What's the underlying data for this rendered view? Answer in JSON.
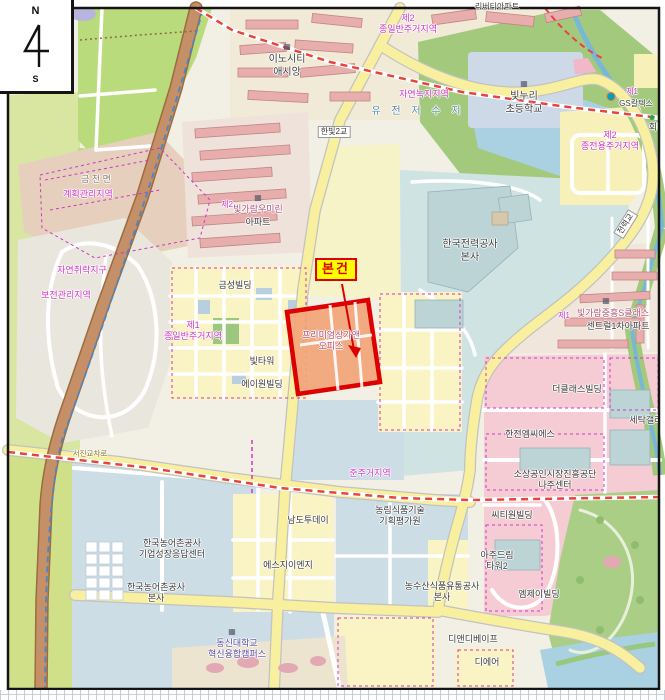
{
  "compass": {
    "north": "N",
    "south": "S"
  },
  "palette": {
    "zone-magenta": "#cf36c4",
    "subject-red": "#dd0000",
    "subject-bg": "#ffff00",
    "poi-dark": "#3c3c3c",
    "water-blue": "#5a84a0",
    "apt-rose": "#b0567c",
    "univ-purple": "#5a4a9e",
    "road-olive": "#8a7a28",
    "gray-place": "#8a8172"
  },
  "subject": {
    "tag": "본건",
    "parcel_name": "프리미엄상가앤\n오피스"
  },
  "labels": [
    {
      "name": "apt-liberty",
      "t": "리버티아파트",
      "x": 497,
      "y": 2,
      "c": "small"
    },
    {
      "name": "zone-2nd-general-top",
      "t": "제2\n종일반주거지역",
      "x": 408,
      "y": 13,
      "c": "zone"
    },
    {
      "name": "innocity-icon",
      "t": "▦",
      "x": 287,
      "y": 42,
      "c": "icon"
    },
    {
      "name": "poi-innocity-assiang",
      "t": "이노시티\n애시앙",
      "x": 287,
      "y": 54,
      "c": "big"
    },
    {
      "name": "school-icon",
      "t": "▦",
      "x": 524,
      "y": 79,
      "c": "icon"
    },
    {
      "name": "poi-bitnuri-school",
      "t": "빛누리\n초등학교",
      "x": 524,
      "y": 91,
      "c": "big"
    },
    {
      "name": "gs-logo-dot",
      "t": "",
      "x": 611,
      "y": 92,
      "c": "gsdot"
    },
    {
      "name": "zone-1st-gs",
      "t": "제1",
      "x": 632,
      "y": 87,
      "c": "zone small"
    },
    {
      "name": "poi-gs-caltex",
      "t": "GS칼텍스",
      "x": 636,
      "y": 99,
      "c": "small"
    },
    {
      "name": "green-dot",
      "t": "",
      "x": 652,
      "y": 115,
      "c": "dot"
    },
    {
      "name": "poi-hoedae",
      "t": "회대",
      "x": 657,
      "y": 122,
      "c": ""
    },
    {
      "name": "zone-natural-green",
      "t": "자연녹지지역",
      "x": 424,
      "y": 89,
      "c": "zone"
    },
    {
      "name": "water-yujeon-reservoir",
      "t": "유 전 저 수 지",
      "x": 418,
      "y": 106,
      "c": "water"
    },
    {
      "name": "bridge-hanbit2",
      "t": "한빛2교",
      "x": 334,
      "y": 126,
      "c": "bridge"
    },
    {
      "name": "zone-2nd-exclusive",
      "t": "제2\n종전용주거지역",
      "x": 610,
      "y": 130,
      "c": "zone"
    },
    {
      "name": "bridge-jeonryeok",
      "t": "전력교",
      "x": 626,
      "y": 218,
      "c": "bridge",
      "rot": -58
    },
    {
      "name": "place-geumcheon",
      "t": "금 천 면",
      "x": 96,
      "y": 174,
      "c": "gray"
    },
    {
      "name": "zone-plan-mgmt",
      "t": "계획관리지역",
      "x": 88,
      "y": 189,
      "c": "zone"
    },
    {
      "name": "zone-natural-settlement",
      "t": "자연취락지구",
      "x": 82,
      "y": 265,
      "c": "zone"
    },
    {
      "name": "zone-preservation",
      "t": "보전관리지역",
      "x": 66,
      "y": 290,
      "c": "zone"
    },
    {
      "name": "zone-2nd-umirin",
      "t": "제2",
      "x": 227,
      "y": 200,
      "c": "zone small"
    },
    {
      "name": "umirin-icon",
      "t": "▦",
      "x": 258,
      "y": 193,
      "c": "icon"
    },
    {
      "name": "apt-umirin",
      "t": "빛가람우미린",
      "x": 258,
      "y": 204,
      "c": "apt"
    },
    {
      "name": "apt-umirin-suffix",
      "t": "아파트",
      "x": 258,
      "y": 217,
      "c": ""
    },
    {
      "name": "poi-geumseong-bldg",
      "t": "금성빌딩",
      "x": 235,
      "y": 280,
      "c": ""
    },
    {
      "name": "zone-1st-general",
      "t": "제1\n종일반주거지역",
      "x": 193,
      "y": 320,
      "c": "zone"
    },
    {
      "name": "poi-bit-tower",
      "t": "빛타워",
      "x": 262,
      "y": 356,
      "c": ""
    },
    {
      "name": "poi-a-one-bldg",
      "t": "에이원빌딩",
      "x": 262,
      "y": 379,
      "c": ""
    },
    {
      "name": "subject-tag",
      "t": "본건",
      "x": 336,
      "y": 258,
      "c": "subject-tag"
    },
    {
      "name": "subject-parcel-name",
      "t": "프리미엄상가앤\n오피스",
      "x": 331,
      "y": 330,
      "c": "apt"
    },
    {
      "name": "poi-kepco-hq",
      "t": "한국전력공사\n본사",
      "x": 470,
      "y": 239,
      "c": "big"
    },
    {
      "name": "zone-1st-jungheung",
      "t": "제1",
      "x": 564,
      "y": 311,
      "c": "zone small"
    },
    {
      "name": "jungheung-icon",
      "t": "▦",
      "x": 606,
      "y": 296,
      "c": "icon"
    },
    {
      "name": "apt-jungheung-sclass",
      "t": "빛가람중흥S클래스",
      "x": 613,
      "y": 308,
      "c": "apt"
    },
    {
      "name": "apt-jungheung-central",
      "t": "센트럴1차아파트",
      "x": 618,
      "y": 321,
      "c": ""
    },
    {
      "name": "poi-theclass-bldg",
      "t": "더클래스빌딩",
      "x": 577,
      "y": 384,
      "c": ""
    },
    {
      "name": "poi-setak-gallery",
      "t": "세탁갤러리",
      "x": 650,
      "y": 415,
      "c": ""
    },
    {
      "name": "poi-kepco-mcs",
      "t": "한전엠씨에스",
      "x": 530,
      "y": 429,
      "c": ""
    },
    {
      "name": "zone-semi-residential",
      "t": "준주거지역",
      "x": 370,
      "y": 468,
      "c": "zone"
    },
    {
      "name": "poi-sosang-center",
      "t": "소상공인시장진흥공단\n나주센터",
      "x": 555,
      "y": 469,
      "c": ""
    },
    {
      "name": "poi-cityone-bldg",
      "t": "씨티원빌딩",
      "x": 512,
      "y": 510,
      "c": ""
    },
    {
      "name": "poi-nonglim-institute",
      "t": "농림식품기술\n기획평가원",
      "x": 400,
      "y": 505,
      "c": ""
    },
    {
      "name": "poi-namdo-today",
      "t": "남도투데이",
      "x": 308,
      "y": 515,
      "c": ""
    },
    {
      "name": "poi-ajudream-tower",
      "t": "아주드림\n타워2",
      "x": 497,
      "y": 550,
      "c": ""
    },
    {
      "name": "poi-krc-growth-center",
      "t": "한국농어촌공사\n기업성장응답센터",
      "x": 172,
      "y": 538,
      "c": ""
    },
    {
      "name": "poi-sg-eng",
      "t": "에스지이엔지",
      "x": 288,
      "y": 560,
      "c": ""
    },
    {
      "name": "poi-at-corp",
      "t": "농수산식품유통공사\n본사",
      "x": 442,
      "y": 581,
      "c": ""
    },
    {
      "name": "poi-krc-hq",
      "t": "한국농어촌공사\n본사",
      "x": 156,
      "y": 582,
      "c": ""
    },
    {
      "name": "poi-mj-bldg",
      "t": "엠제이빌딩",
      "x": 539,
      "y": 589,
      "c": ""
    },
    {
      "name": "poi-dnd-vape",
      "t": "디앤디베이프",
      "x": 473,
      "y": 634,
      "c": ""
    },
    {
      "name": "dongshin-icon",
      "t": "▦",
      "x": 232,
      "y": 627,
      "c": "icon"
    },
    {
      "name": "poi-dongshin-univ",
      "t": "동신대학교\n혁신융합캠퍼스",
      "x": 237,
      "y": 638,
      "c": "univ"
    },
    {
      "name": "poi-deair",
      "t": "디에어",
      "x": 487,
      "y": 657,
      "c": ""
    },
    {
      "name": "road-seojin-ix",
      "t": "서진교차로",
      "x": 90,
      "y": 449,
      "c": "roadlbl"
    }
  ]
}
